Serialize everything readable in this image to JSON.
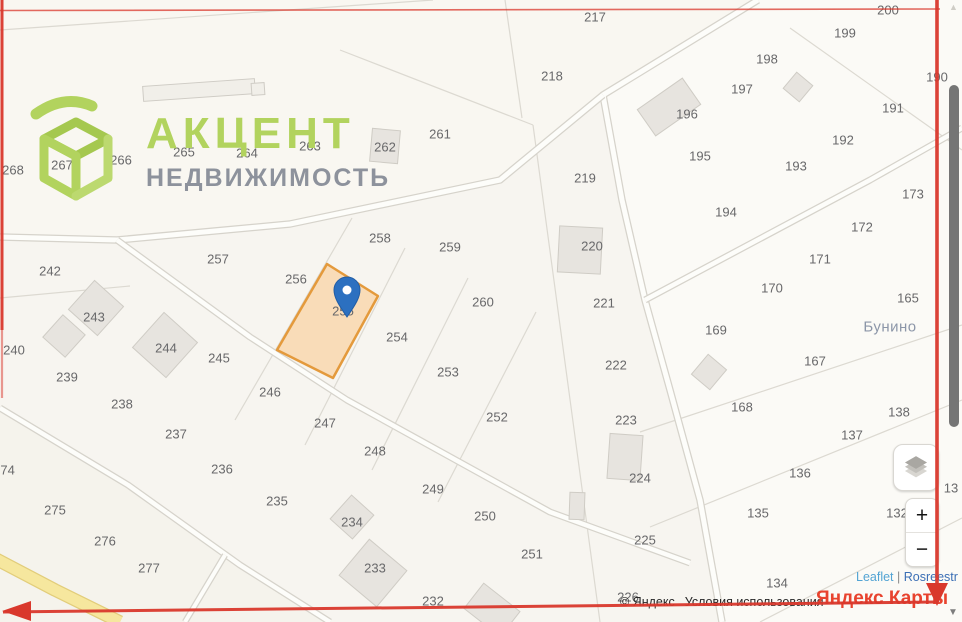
{
  "logo": {
    "title": "АКЦЕНТ",
    "subtitle": "НЕДВИЖИМОСТЬ",
    "accent_color": "#b2d35e",
    "subtitle_color": "#8d929c"
  },
  "map": {
    "background": "#f7f5f0",
    "boundary_color": "#dcd9d1",
    "road_fill": "#fdfdfa",
    "road_casing": "#d6d3cb",
    "label_color": "#68686a",
    "place": {
      "label": "Бунино",
      "x": 890,
      "y": 327,
      "color": "#8c96a8"
    },
    "block_fills": [
      {
        "points": "758,0 962,0 962,622 725,622 700,500 645,300 603,95",
        "fill": "#fbfaf6"
      },
      {
        "points": "0,0 758,0 603,95 500,180 290,224 117,240 0,237",
        "fill": "#f9f7f1"
      },
      {
        "points": "0,408 128,485 240,565 330,622 0,622",
        "fill": "#f5f3ec"
      }
    ],
    "boundaries": [
      [
        0,
        30,
        433,
        0
      ],
      [
        340,
        50,
        533,
        125
      ],
      [
        533,
        125,
        600,
        622
      ],
      [
        505,
        0,
        522,
        118
      ],
      [
        790,
        28,
        962,
        150
      ],
      [
        352,
        218,
        235,
        420
      ],
      [
        405,
        248,
        305,
        445
      ],
      [
        468,
        278,
        372,
        470
      ],
      [
        536,
        312,
        438,
        502
      ],
      [
        640,
        432,
        962,
        325
      ],
      [
        650,
        527,
        962,
        400
      ],
      [
        760,
        622,
        962,
        518
      ],
      [
        0,
        298,
        130,
        286
      ]
    ],
    "roads": [
      {
        "pts": [
          [
            758,
            0
          ],
          [
            603,
            95
          ],
          [
            622,
            200
          ],
          [
            645,
            300
          ],
          [
            670,
            390
          ],
          [
            700,
            500
          ],
          [
            722,
            622
          ]
        ],
        "w": 5
      },
      {
        "pts": [
          [
            0,
            237
          ],
          [
            117,
            240
          ],
          [
            290,
            224
          ],
          [
            500,
            180
          ],
          [
            603,
            95
          ]
        ],
        "w": 5
      },
      {
        "pts": [
          [
            117,
            240
          ],
          [
            250,
            337
          ],
          [
            347,
            400
          ],
          [
            550,
            512
          ],
          [
            690,
            563
          ]
        ],
        "w": 4.5
      },
      {
        "pts": [
          [
            0,
            408
          ],
          [
            128,
            485
          ],
          [
            240,
            565
          ],
          [
            330,
            622
          ]
        ],
        "w": 4.5
      },
      {
        "pts": [
          [
            225,
            555
          ],
          [
            185,
            622
          ]
        ],
        "w": 4
      },
      {
        "pts": [
          [
            645,
            300
          ],
          [
            870,
            180
          ],
          [
            962,
            128
          ]
        ],
        "w": 4.5
      },
      {
        "pts": [
          [
            -6,
            558
          ],
          [
            55,
            590
          ],
          [
            120,
            622
          ]
        ],
        "w": 11,
        "fill": "#f6e79e",
        "casing": "#e2cd7a"
      }
    ],
    "buildings": [
      {
        "x": 199,
        "y": 90,
        "w": 112,
        "h": 15,
        "r": -4,
        "f": "#f1efe9"
      },
      {
        "x": 258,
        "y": 89,
        "w": 13,
        "h": 12,
        "r": -4,
        "f": "#f1efe9"
      },
      {
        "x": 669,
        "y": 107,
        "w": 55,
        "h": 32,
        "r": -35
      },
      {
        "x": 798,
        "y": 87,
        "w": 21,
        "h": 21,
        "r": 40
      },
      {
        "x": 385,
        "y": 146,
        "w": 28,
        "h": 33,
        "r": 5
      },
      {
        "x": 580,
        "y": 250,
        "w": 43,
        "h": 46,
        "r": 3
      },
      {
        "x": 96,
        "y": 308,
        "w": 39,
        "h": 39,
        "r": 42
      },
      {
        "x": 64,
        "y": 336,
        "w": 30,
        "h": 30,
        "r": 42
      },
      {
        "x": 165,
        "y": 345,
        "w": 45,
        "h": 47,
        "r": 42
      },
      {
        "x": 709,
        "y": 372,
        "w": 24,
        "h": 26,
        "r": 40
      },
      {
        "x": 625,
        "y": 457,
        "w": 33,
        "h": 45,
        "r": 4
      },
      {
        "x": 577,
        "y": 506,
        "w": 15,
        "h": 27,
        "r": 2
      },
      {
        "x": 352,
        "y": 517,
        "w": 30,
        "h": 32,
        "r": 42
      },
      {
        "x": 373,
        "y": 573,
        "w": 49,
        "h": 47,
        "r": 40
      },
      {
        "x": 492,
        "y": 610,
        "w": 46,
        "h": 32,
        "r": 38
      }
    ],
    "selected_parcel": {
      "number": "255",
      "label_x": 343,
      "label_y": 311,
      "points": "327,264 378,296 333,378 277,350",
      "fill": "#f9dcb8",
      "stroke": "#e49a3c"
    },
    "pin": {
      "x": 347,
      "y": 317,
      "color": "#2c70c0",
      "stroke": "#215da5"
    },
    "parcel_labels": [
      {
        "t": "268",
        "x": 13,
        "y": 170
      },
      {
        "t": "267",
        "x": 62,
        "y": 165
      },
      {
        "t": "266",
        "x": 121,
        "y": 160
      },
      {
        "t": "265",
        "x": 184,
        "y": 152
      },
      {
        "t": "264",
        "x": 247,
        "y": 153
      },
      {
        "t": "263",
        "x": 310,
        "y": 146
      },
      {
        "t": "262",
        "x": 385,
        "y": 147
      },
      {
        "t": "261",
        "x": 440,
        "y": 134
      },
      {
        "t": "217",
        "x": 595,
        "y": 17
      },
      {
        "t": "218",
        "x": 552,
        "y": 76
      },
      {
        "t": "200",
        "x": 888,
        "y": 10
      },
      {
        "t": "199",
        "x": 845,
        "y": 33
      },
      {
        "t": "198",
        "x": 767,
        "y": 59
      },
      {
        "t": "197",
        "x": 742,
        "y": 89
      },
      {
        "t": "196",
        "x": 687,
        "y": 114
      },
      {
        "t": "195",
        "x": 700,
        "y": 156
      },
      {
        "t": "193",
        "x": 796,
        "y": 166
      },
      {
        "t": "194",
        "x": 726,
        "y": 212
      },
      {
        "t": "191",
        "x": 893,
        "y": 108
      },
      {
        "t": "192",
        "x": 843,
        "y": 140
      },
      {
        "t": "190",
        "x": 937,
        "y": 77
      },
      {
        "t": "173",
        "x": 913,
        "y": 194
      },
      {
        "t": "172",
        "x": 862,
        "y": 227
      },
      {
        "t": "171",
        "x": 820,
        "y": 259
      },
      {
        "t": "170",
        "x": 772,
        "y": 288
      },
      {
        "t": "165",
        "x": 908,
        "y": 298
      },
      {
        "t": "169",
        "x": 716,
        "y": 330
      },
      {
        "t": "167",
        "x": 815,
        "y": 361
      },
      {
        "t": "168",
        "x": 742,
        "y": 407
      },
      {
        "t": "138",
        "x": 899,
        "y": 412
      },
      {
        "t": "137",
        "x": 852,
        "y": 435
      },
      {
        "t": "136",
        "x": 800,
        "y": 473
      },
      {
        "t": "135",
        "x": 758,
        "y": 513
      },
      {
        "t": "132",
        "x": 897,
        "y": 513
      },
      {
        "t": "134",
        "x": 777,
        "y": 583
      },
      {
        "t": "13",
        "x": 951,
        "y": 488
      },
      {
        "t": "219",
        "x": 585,
        "y": 178
      },
      {
        "t": "220",
        "x": 592,
        "y": 246
      },
      {
        "t": "221",
        "x": 604,
        "y": 303
      },
      {
        "t": "222",
        "x": 616,
        "y": 365
      },
      {
        "t": "223",
        "x": 626,
        "y": 420
      },
      {
        "t": "224",
        "x": 640,
        "y": 478
      },
      {
        "t": "225",
        "x": 645,
        "y": 540
      },
      {
        "t": "226",
        "x": 628,
        "y": 597
      },
      {
        "t": "257",
        "x": 218,
        "y": 259
      },
      {
        "t": "258",
        "x": 380,
        "y": 238
      },
      {
        "t": "259",
        "x": 450,
        "y": 247
      },
      {
        "t": "256",
        "x": 296,
        "y": 279
      },
      {
        "t": "260",
        "x": 483,
        "y": 302
      },
      {
        "t": "254",
        "x": 397,
        "y": 337
      },
      {
        "t": "253",
        "x": 448,
        "y": 372
      },
      {
        "t": "252",
        "x": 497,
        "y": 417
      },
      {
        "t": "242",
        "x": 50,
        "y": 271
      },
      {
        "t": "243",
        "x": 94,
        "y": 317
      },
      {
        "t": "244",
        "x": 166,
        "y": 348
      },
      {
        "t": "240",
        "x": 14,
        "y": 350
      },
      {
        "t": "245",
        "x": 219,
        "y": 358
      },
      {
        "t": "239",
        "x": 67,
        "y": 377
      },
      {
        "t": "238",
        "x": 122,
        "y": 404
      },
      {
        "t": "246",
        "x": 270,
        "y": 392
      },
      {
        "t": "247",
        "x": 325,
        "y": 423
      },
      {
        "t": "237",
        "x": 176,
        "y": 434
      },
      {
        "t": "248",
        "x": 375,
        "y": 451
      },
      {
        "t": "236",
        "x": 222,
        "y": 469
      },
      {
        "t": "249",
        "x": 433,
        "y": 489
      },
      {
        "t": "274",
        "x": 4,
        "y": 470
      },
      {
        "t": "235",
        "x": 277,
        "y": 501
      },
      {
        "t": "250",
        "x": 485,
        "y": 516
      },
      {
        "t": "275",
        "x": 55,
        "y": 510
      },
      {
        "t": "234",
        "x": 352,
        "y": 522
      },
      {
        "t": "251",
        "x": 532,
        "y": 554
      },
      {
        "t": "276",
        "x": 105,
        "y": 541
      },
      {
        "t": "233",
        "x": 375,
        "y": 568
      },
      {
        "t": "277",
        "x": 149,
        "y": 568
      },
      {
        "t": "232",
        "x": 433,
        "y": 601
      }
    ]
  },
  "controls": {
    "zoom_in": "+",
    "zoom_out": "−"
  },
  "attribution": {
    "copyright": "© Яндекс",
    "terms": "Условия использования",
    "brand": "Яндекс Карты",
    "leaflet": "Leaflet",
    "separator": "|",
    "rosreestr": "Rosreestr"
  },
  "scrollbar": {
    "up": "▲",
    "down": "▼",
    "thumb_top": 85,
    "thumb_height": 342
  },
  "annotation": {
    "color": "#d9382c",
    "lines": [
      [
        2,
        0,
        2,
        330,
        3,
        0.95
      ],
      [
        2,
        330,
        2,
        398,
        2.2,
        0.5
      ],
      [
        0,
        10.5,
        940,
        9,
        1.6,
        0.75
      ],
      [
        937,
        0,
        937,
        588,
        3.6,
        0.95
      ],
      [
        3,
        612,
        935,
        602,
        3,
        0.95
      ]
    ],
    "arrows": [
      "926,583 948,583 937,606",
      "31,601 31,621 2,611"
    ]
  }
}
